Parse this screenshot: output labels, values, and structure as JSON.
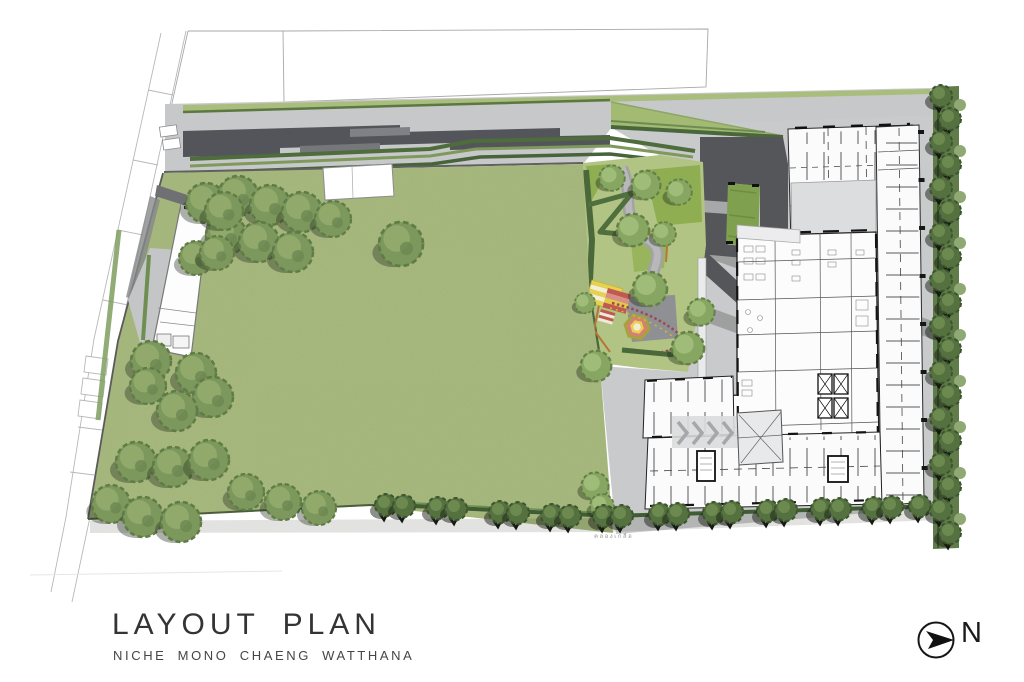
{
  "title_block": {
    "title": "LAYOUT PLAN",
    "subtitle": "NICHE MONO CHAENG WATTHANA"
  },
  "compass": {
    "label": "N",
    "orientation": "north-points-right"
  },
  "annotations": {
    "canal_label": "คลองเกลือ"
  },
  "palette": {
    "lawn": "#a8ba7e",
    "garden_base": "#b2c483",
    "bright_green": "#8fae52",
    "hedge_dark": "#4a683a",
    "tree_olive": "#7d985c",
    "tree_dark": "#55713f",
    "asphalt": "#54555a",
    "paving": "#c9cacb",
    "drive_dark": "#55565a",
    "island_green": "#7fa04f",
    "play_yellow": "#e8cf55",
    "play_red": "#bf5a50",
    "play_pink": "#d77f76",
    "play_cream": "#f3ecd0",
    "edging_orange": "#b5763c",
    "wall_ink": "#2b2b2b",
    "title_ink": "#343434"
  }
}
